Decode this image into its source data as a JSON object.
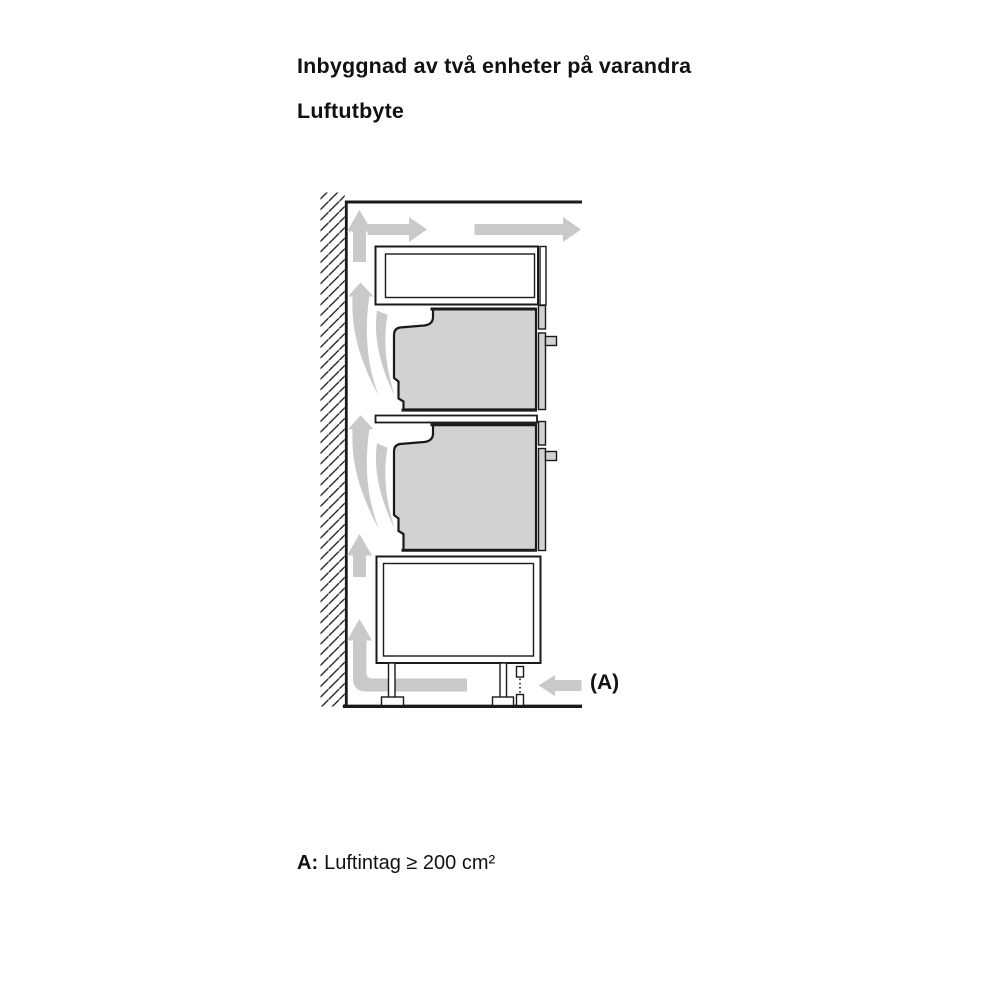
{
  "page": {
    "background": "#ffffff",
    "title": "Inbyggnad av två enheter på varandra",
    "subtitle": "Luftutbyte",
    "caption": {
      "prefix": "A:",
      "text": "Luftintag ≥ 200 cm²"
    },
    "callout_a": "(A)"
  },
  "diagram": {
    "colors": {
      "outline": "#1a1a1a",
      "airflow_arrow": "#c9c9c9",
      "appliance_fill": "#d2d2d2",
      "cabinet_fill": "#ffffff"
    },
    "icons": {
      "wall": "diagonal-hatch-wall",
      "airflow_up": "up-arrow",
      "airflow_right": "right-arrow",
      "air_intake": "left-arrow",
      "plinth_gap": "dashed-spacer"
    }
  }
}
